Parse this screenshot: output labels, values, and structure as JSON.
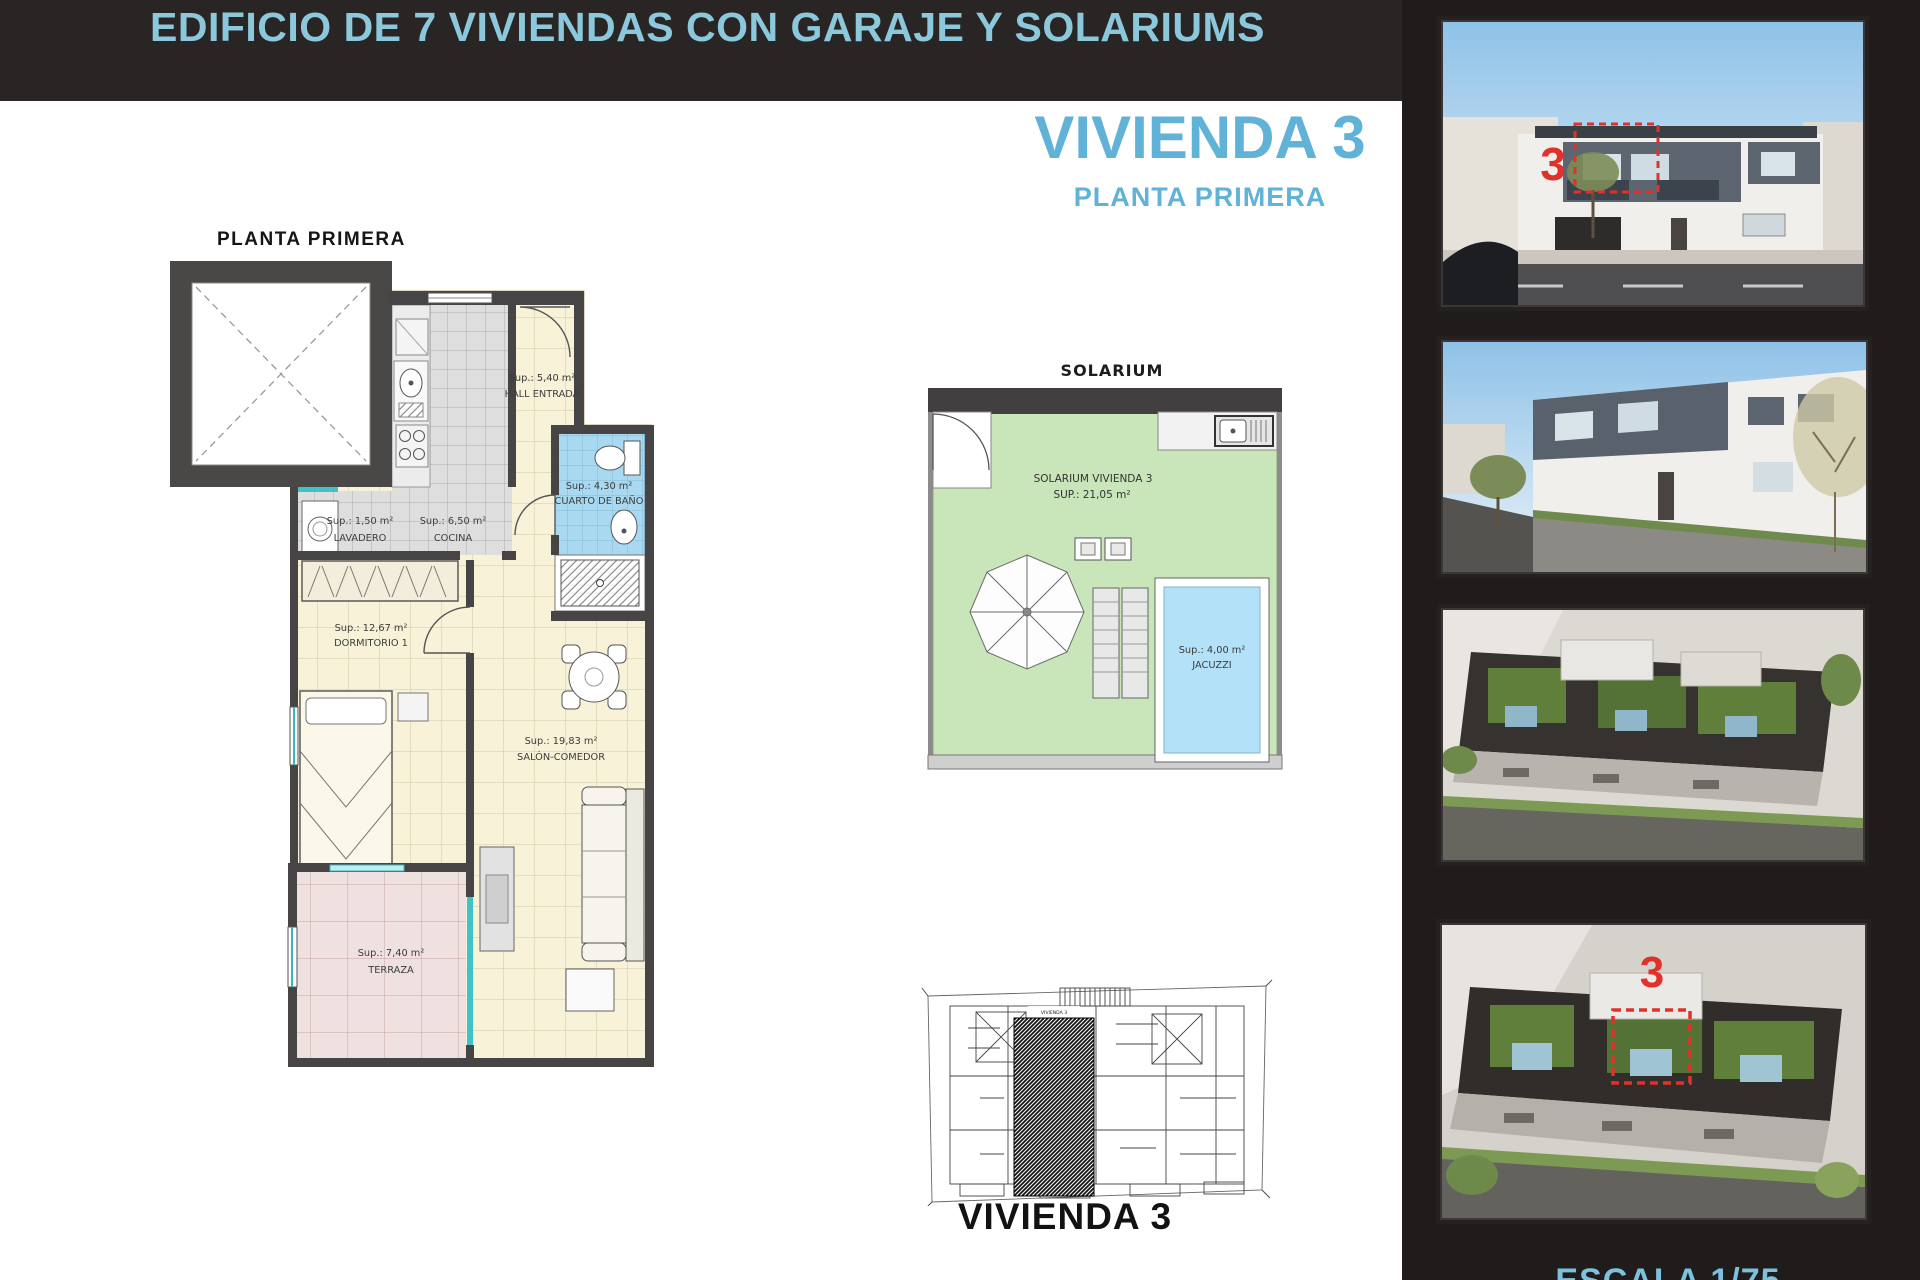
{
  "banner": {
    "title": "EDIFICIO DE 7 VIVIENDAS CON GARAJE Y SOLARIUMS"
  },
  "heading": {
    "title": "VIVIENDA 3",
    "subtitle": "PLANTA PRIMERA"
  },
  "floor_plan": {
    "label": "PLANTA PRIMERA",
    "rooms": [
      {
        "area": "Sup.: 5,40 m²",
        "name": "HALL ENTRADA"
      },
      {
        "area": "Sup.: 4,30 m²",
        "name": "CUARTO DE BAÑO"
      },
      {
        "area": "Sup.: 1,50 m²",
        "name": "LAVADERO"
      },
      {
        "area": "Sup.: 6,50 m²",
        "name": "COCINA"
      },
      {
        "area": "Sup.: 12,67 m²",
        "name": "DORMITORIO 1"
      },
      {
        "area": "Sup.: 19,83 m²",
        "name": "SALÓN-COMEDOR"
      },
      {
        "area": "Sup.: 7,40 m²",
        "name": "TERRAZA"
      }
    ]
  },
  "solarium": {
    "title": "SOLARIUM",
    "label_line1": "SOLARIUM VIVIENDA 3",
    "label_line2": "SUP.: 21,05 m²",
    "jacuzzi_area": "Sup.: 4,00 m²",
    "jacuzzi_name": "JACUZZI"
  },
  "key_plan": {
    "unit_tag": "VIVIENDA 3",
    "caption": "VIVIENDA 3"
  },
  "sidebar": {
    "photos": [
      {
        "label": "front-elevation-render",
        "marker": "3"
      },
      {
        "label": "corner-street-render"
      },
      {
        "label": "aerial-rooftop-render"
      },
      {
        "label": "aerial-rooftop-marked-render",
        "marker": "3"
      }
    ],
    "scale_caption": "ESCALA 1/75"
  },
  "colors": {
    "banner_bg": "#292525",
    "sidebar_bg": "#201c1c",
    "accent_cyan_text": "#60b2d6",
    "banner_text": "#8cc8dc",
    "marker_red": "#e0312a",
    "wall": "#474445",
    "floor_cream": "#f7f2d8",
    "floor_gray": "#e0e0e0",
    "floor_blue": "#a9d9f0",
    "floor_pink": "#f0e1e1",
    "solarium_green": "#c9e5ba",
    "jacuzzi_blue": "#b3e1f7",
    "glass_cyan": "#3fc3c9"
  }
}
